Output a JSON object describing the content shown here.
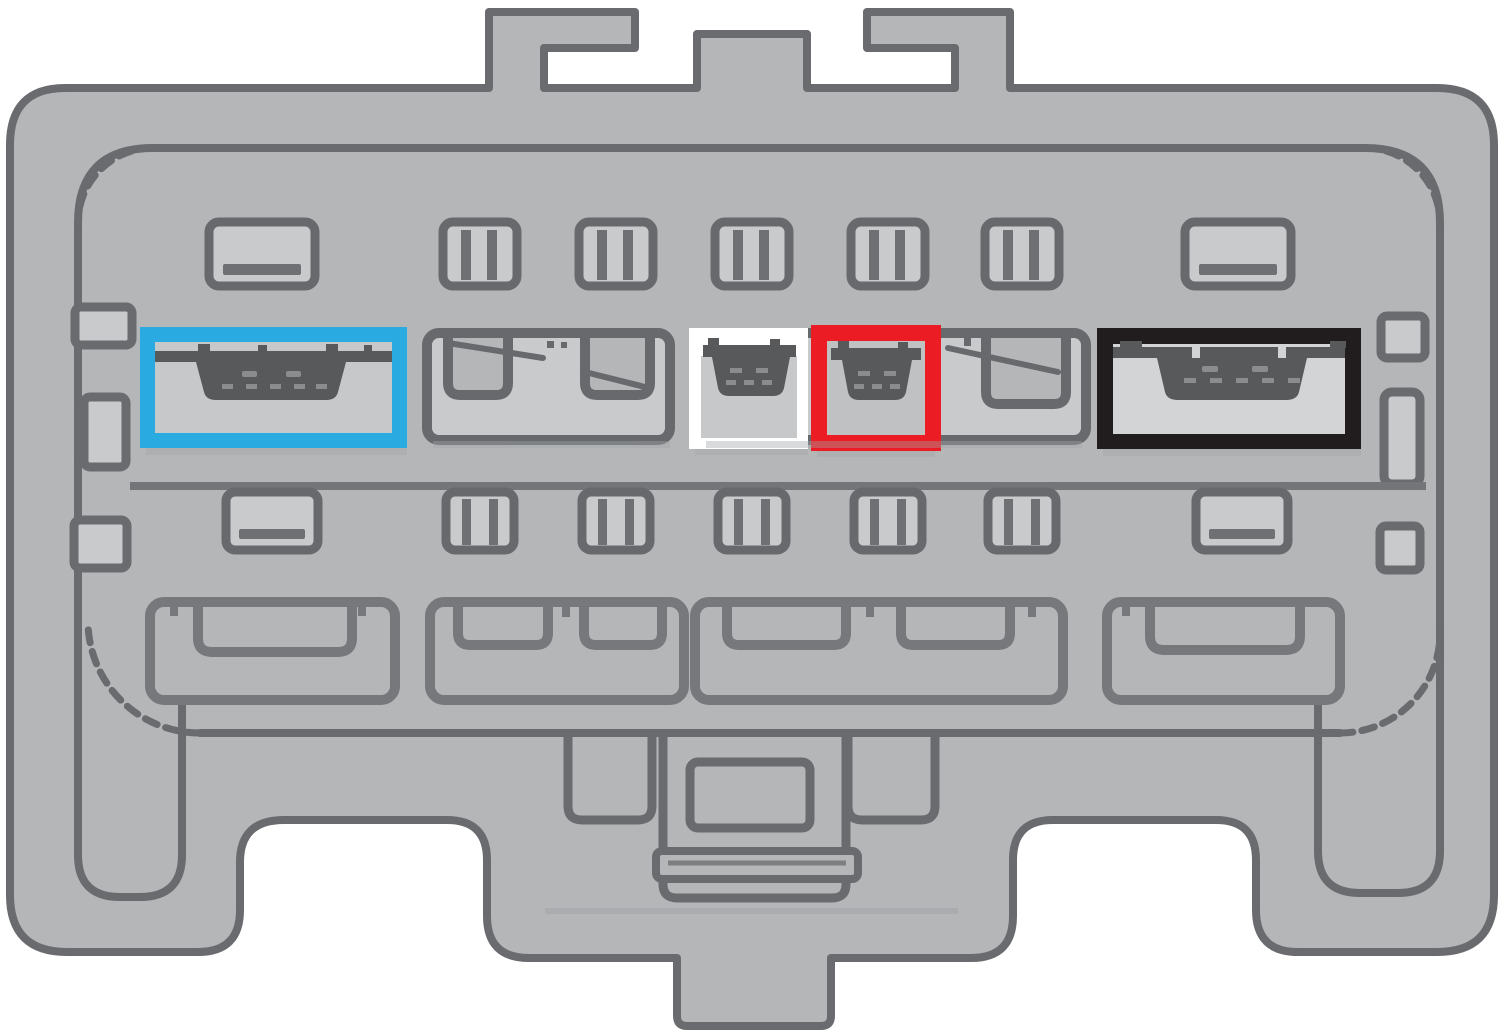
{
  "diagram": {
    "kind": "wiring-harness-connector-face",
    "top_mounting_tabs": 3,
    "bottom_latch_tab": 1,
    "rows": [
      {
        "name": "row-1-small-cavities",
        "wide_cavities": 2,
        "small_cavities": 5
      },
      {
        "name": "row-2-terminal-cavities",
        "positions": 6
      },
      {
        "name": "row-3-small-cavities",
        "wide_cavities": 2,
        "small_cavities": 5
      },
      {
        "name": "row-4-large-cavities",
        "positions": 4
      }
    ],
    "highlights": [
      {
        "id": "cyan-highlight-box",
        "color": "#29ABE2",
        "has_terminal": true
      },
      {
        "id": "white-highlight-box",
        "color": "#FFFFFF",
        "has_terminal": true
      },
      {
        "id": "red-highlight-box",
        "color": "#EC1C24",
        "has_terminal": true
      },
      {
        "id": "black-highlight-box",
        "color": "#211D1E",
        "has_terminal": true
      }
    ]
  },
  "colors": {
    "page_bg": "#FFFFFF",
    "body_fill": "#B4B6B8",
    "outline": "#696B6E",
    "slot_fill": "#C8CACC",
    "slot_stroke": "#67696C",
    "slot_bar": "#6E7073",
    "row4_stroke": "#76787B",
    "divider": "#737578",
    "terminal_dark": "#58595B",
    "terminal_dash": "#8A8C8E",
    "shadow": "#A3A5A8",
    "cyan": "#29ABE2",
    "red": "#EC1C24",
    "black": "#211D1E",
    "white": "#FFFFFF",
    "red_inner": "#BFC1C3",
    "black_inner": "#D2D4D6",
    "white_inner": "#C6C8CA"
  }
}
